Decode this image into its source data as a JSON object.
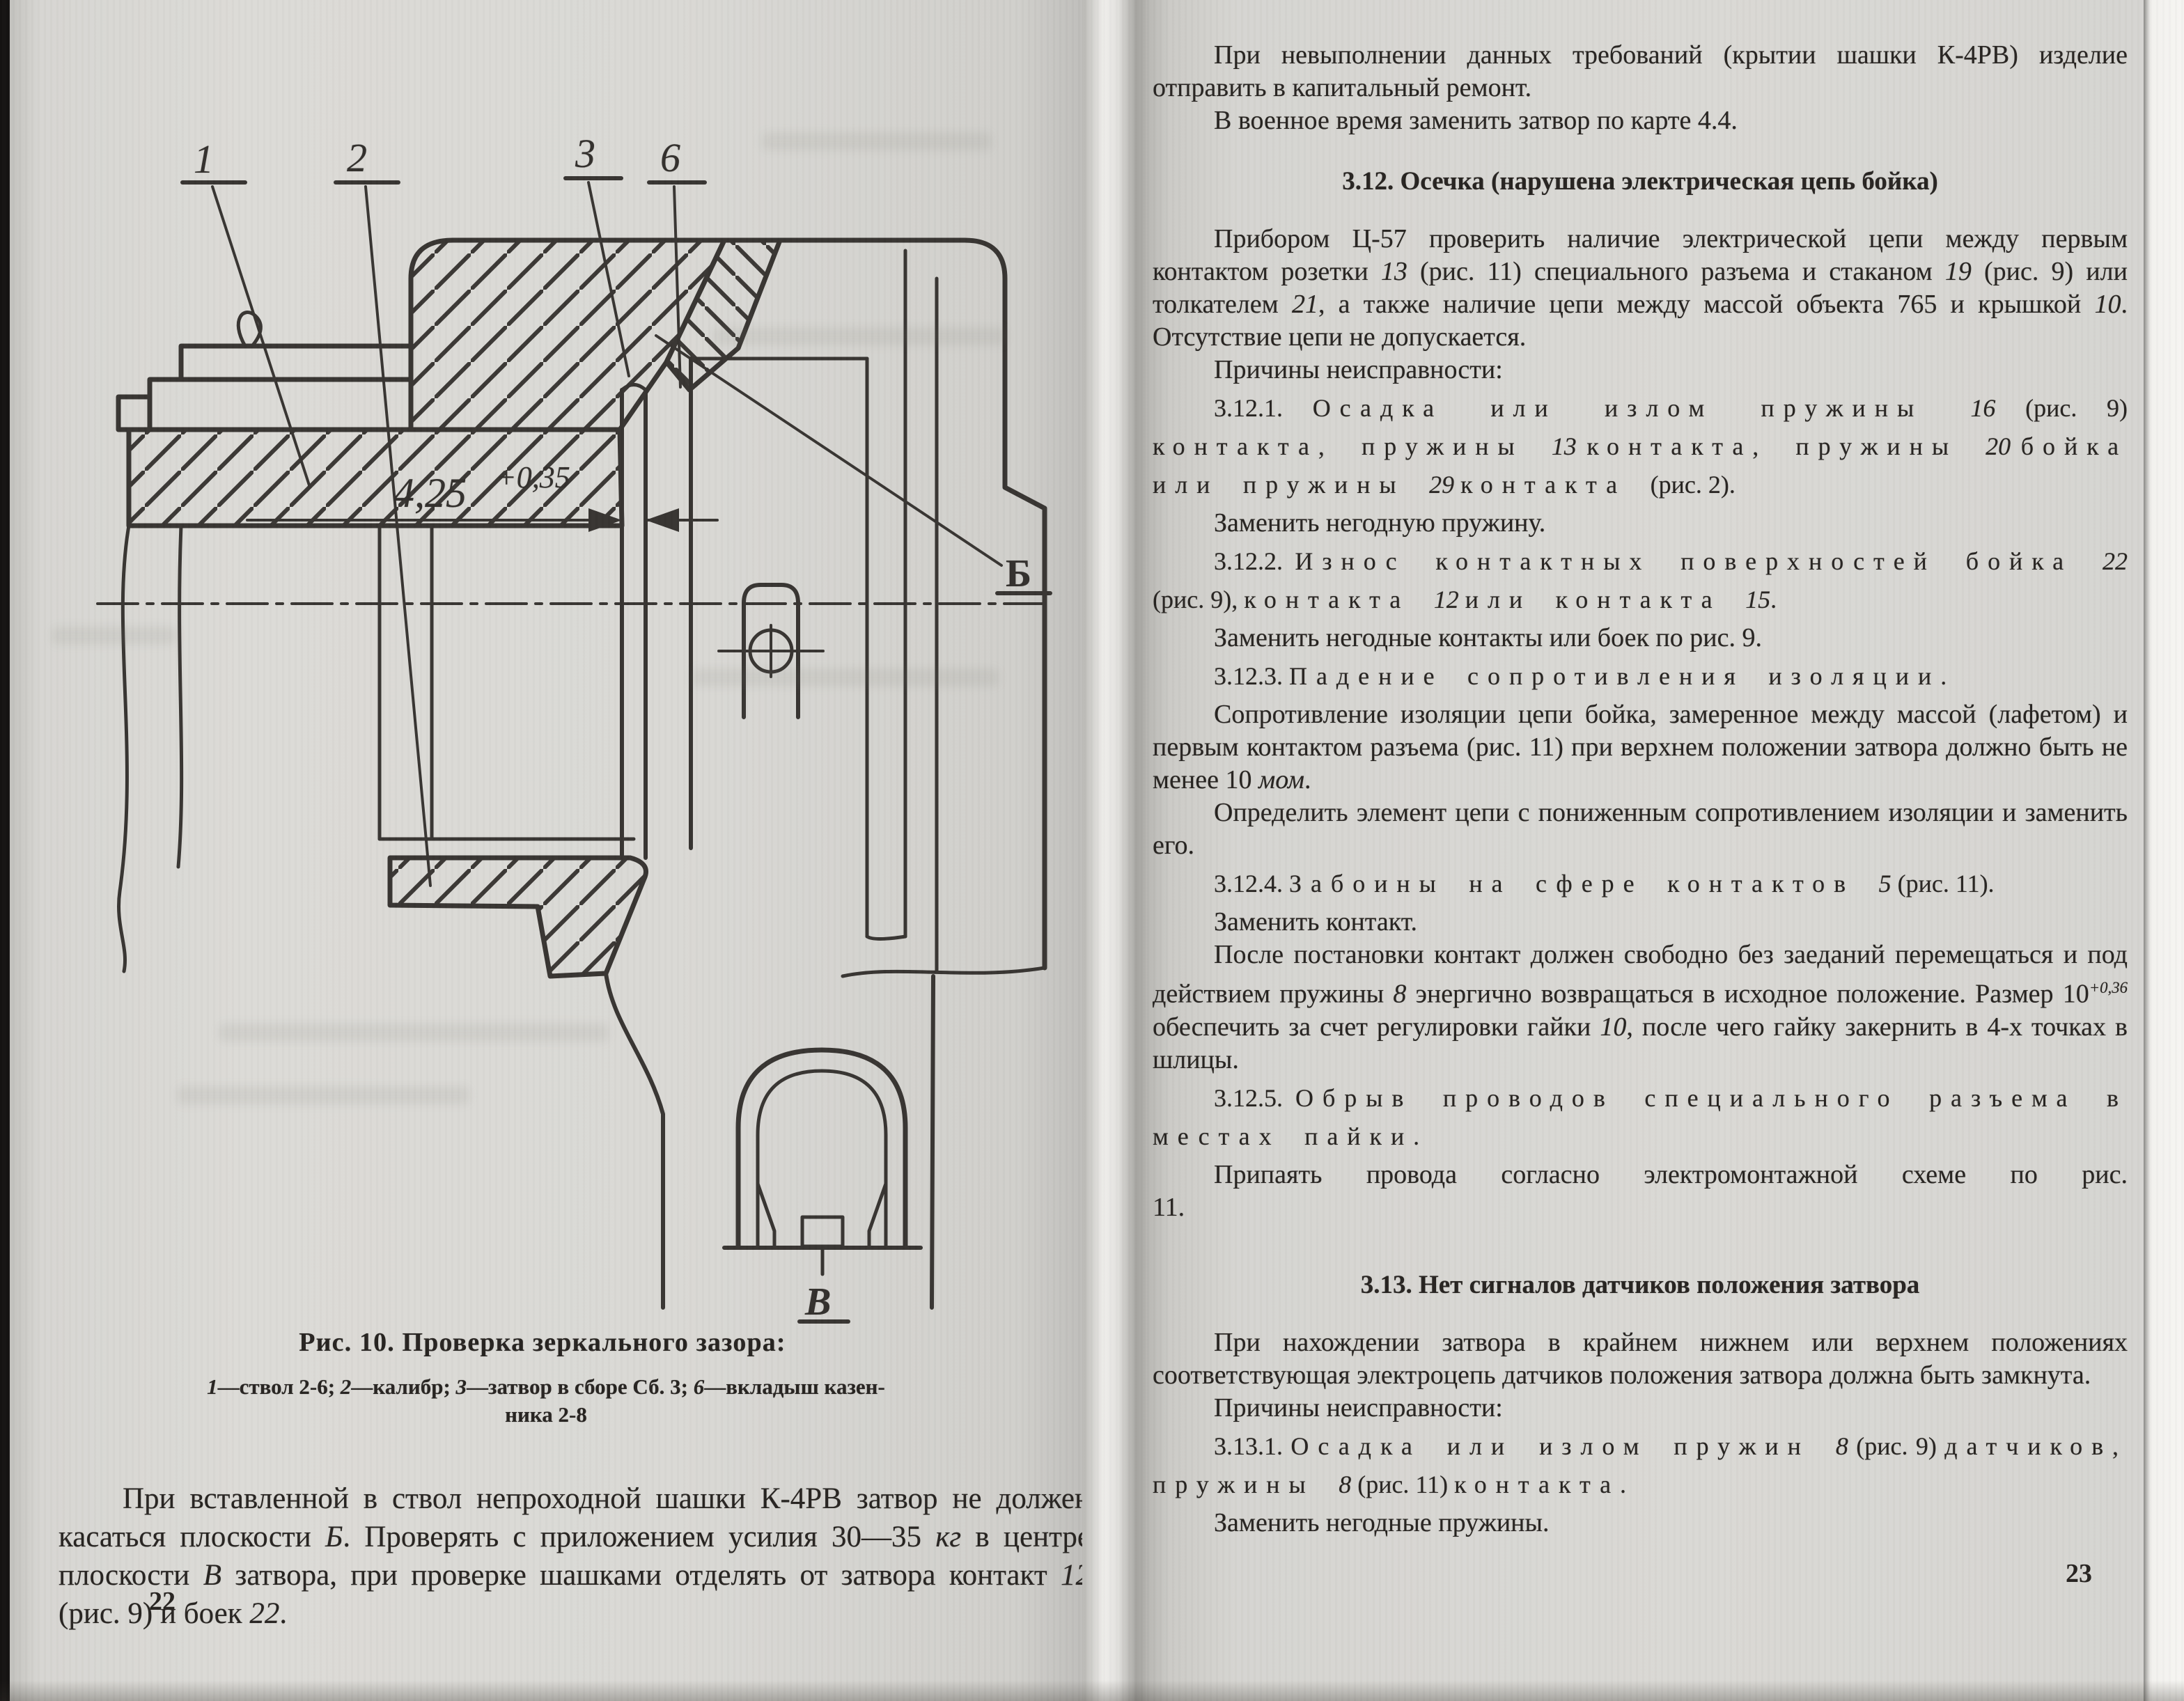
{
  "left_page": {
    "figure": {
      "labels": {
        "l1": "1",
        "l2": "2",
        "l3": "3",
        "l6": "6",
        "b": "Б",
        "v": "В"
      },
      "dimension": "4,25",
      "dimension_tol": "+0,35"
    },
    "caption": "Рис. 10. Проверка зеркального зазора:",
    "legend_line1_runs": [
      [
        "1",
        "i"
      ],
      [
        "—ствол 2-6;  ",
        ""
      ],
      [
        "2",
        "i"
      ],
      [
        "—калибр;  ",
        ""
      ],
      [
        "3",
        "i"
      ],
      [
        "—затвор в сборе Сб. 3;  ",
        ""
      ],
      [
        "6",
        "i"
      ],
      [
        "—вкладыш казен-",
        ""
      ]
    ],
    "legend_line2_runs": [
      [
        "ника 2-8",
        ""
      ]
    ],
    "para_runs": [
      [
        "При вставленной в ствол непроходной шашки К-4РВ затвор не должен касаться плоскости ",
        ""
      ],
      [
        "Б",
        "i"
      ],
      [
        ". Проверять с приложением усилия 30—35 ",
        ""
      ],
      [
        "кг",
        "i"
      ],
      [
        " в центре плоскости ",
        ""
      ],
      [
        "В",
        "i"
      ],
      [
        " затвора, при проверке шашками отделять от затвора контакт ",
        ""
      ],
      [
        "12",
        "i"
      ],
      [
        " (рис. 9) и боек ",
        ""
      ],
      [
        "22",
        "i"
      ],
      [
        ".",
        ""
      ]
    ],
    "page_number": "22"
  },
  "right_page": {
    "page_number": "23",
    "blocks": [
      {
        "kind": "p",
        "runs": [
          [
            "При невыполнении данных требований (крытии шашки К-4РВ) изделие отправить в капитальный ремонт.",
            ""
          ]
        ]
      },
      {
        "kind": "p",
        "runs": [
          [
            "В военное время заменить затвор по карте 4.4.",
            ""
          ]
        ]
      },
      {
        "kind": "h",
        "runs": [
          [
            "3.12. Осечка (нарушена электрическая цепь бойка)",
            ""
          ]
        ]
      },
      {
        "kind": "p",
        "runs": [
          [
            "Прибором Ц-57 проверить наличие электрической цепи между первым контактом розетки ",
            ""
          ],
          [
            "13",
            "i"
          ],
          [
            " (рис. 11) специального разъема и стаканом ",
            ""
          ],
          [
            "19",
            "i"
          ],
          [
            " (рис. 9) или толкателем ",
            ""
          ],
          [
            "21",
            "i"
          ],
          [
            ", а также наличие цепи между массой объекта 765 и крышкой ",
            ""
          ],
          [
            "10",
            "i"
          ],
          [
            ". Отсутствие цепи не допускается.",
            ""
          ]
        ]
      },
      {
        "kind": "p",
        "runs": [
          [
            "Причины неисправности:",
            ""
          ]
        ]
      },
      {
        "kind": "sp",
        "runs": [
          [
            "3.12.1. ",
            ""
          ],
          [
            "Осадка или излом пружины ",
            "s"
          ],
          [
            "16",
            "i"
          ],
          [
            " (рис. 9) ",
            ""
          ],
          [
            "контакта, пружины ",
            "s"
          ],
          [
            "13",
            "i"
          ],
          [
            " ",
            ""
          ],
          [
            "контакта, пружины ",
            "s"
          ],
          [
            "20",
            "i"
          ],
          [
            " ",
            ""
          ],
          [
            "бойка или пружины ",
            "s"
          ],
          [
            "29",
            "i"
          ],
          [
            " ",
            ""
          ],
          [
            "контакта ",
            "s"
          ],
          [
            "(рис. 2).",
            ""
          ]
        ]
      },
      {
        "kind": "p",
        "runs": [
          [
            "Заменить негодную пружину.",
            ""
          ]
        ]
      },
      {
        "kind": "sp",
        "runs": [
          [
            "3.12.2. ",
            ""
          ],
          [
            "Износ контактных поверхностей бойка ",
            "s"
          ],
          [
            "22",
            "i"
          ],
          [
            " (рис. 9), ",
            ""
          ],
          [
            "контакта ",
            "s"
          ],
          [
            "12",
            "i"
          ],
          [
            " ",
            ""
          ],
          [
            "или контакта ",
            "s"
          ],
          [
            "15",
            "i"
          ],
          [
            ".",
            ""
          ]
        ]
      },
      {
        "kind": "p",
        "runs": [
          [
            "Заменить негодные контакты или боек по рис. 9.",
            ""
          ]
        ]
      },
      {
        "kind": "sp",
        "runs": [
          [
            "3.12.3. ",
            ""
          ],
          [
            "Падение сопротивления изоляции.",
            "s"
          ]
        ]
      },
      {
        "kind": "p",
        "runs": [
          [
            "Сопротивление изоляции цепи бойка, замеренное между массой (лафетом) и первым контактом разъема (рис. 11) при верхнем положении затвора должно быть не менее 10 ",
            ""
          ],
          [
            "мом",
            "i"
          ],
          [
            ".",
            ""
          ]
        ]
      },
      {
        "kind": "p",
        "runs": [
          [
            "Определить элемент цепи с пониженным сопротивлением изоляции и заменить его.",
            ""
          ]
        ]
      },
      {
        "kind": "sp",
        "runs": [
          [
            "3.12.4. ",
            ""
          ],
          [
            "Забоины на сфере контактов ",
            "s"
          ],
          [
            "5",
            "i"
          ],
          [
            " (рис. 11).",
            ""
          ]
        ]
      },
      {
        "kind": "p",
        "runs": [
          [
            "Заменить контакт.",
            ""
          ]
        ]
      },
      {
        "kind": "p",
        "runs": [
          [
            "После постановки контакт должен свободно без заеданий перемещаться и под действием пружины ",
            ""
          ],
          [
            "8",
            "i"
          ],
          [
            " энергично возвращаться в исходное положение. Размер 10",
            ""
          ],
          [
            "+0,36",
            "sup"
          ],
          [
            "  обеспечить за счет регулировки гайки ",
            ""
          ],
          [
            "10",
            "i"
          ],
          [
            ", после чего гайку закернить в 4-х точках в шлицы.",
            ""
          ]
        ]
      },
      {
        "kind": "sp",
        "runs": [
          [
            "3.12.5. ",
            ""
          ],
          [
            "Обрыв проводов специального разъема в местах пайки.",
            "s"
          ]
        ]
      },
      {
        "kind": "pw",
        "runs": [
          [
            "Припаять провода согласно электромонтажной схеме по рис. 11.",
            ""
          ]
        ]
      },
      {
        "kind": "h2",
        "runs": [
          [
            "3.13. Нет сигналов датчиков положения затвора",
            ""
          ]
        ]
      },
      {
        "kind": "p",
        "runs": [
          [
            "При нахождении затвора в крайнем нижнем или верхнем положениях соответствующая электроцепь датчиков положения затвора должна быть замкнута.",
            ""
          ]
        ]
      },
      {
        "kind": "p",
        "runs": [
          [
            "Причины неисправности:",
            ""
          ]
        ]
      },
      {
        "kind": "sp",
        "runs": [
          [
            "3.13.1. ",
            ""
          ],
          [
            "Осадка или излом пружин ",
            "s"
          ],
          [
            "8",
            "i"
          ],
          [
            " (рис. 9) ",
            ""
          ],
          [
            "датчиков, пружины ",
            "s"
          ],
          [
            "8",
            "i"
          ],
          [
            " (рис. 11) ",
            ""
          ],
          [
            "контакта.",
            "s"
          ]
        ]
      },
      {
        "kind": "p",
        "runs": [
          [
            "Заменить негодные пружины.",
            ""
          ]
        ]
      }
    ]
  }
}
